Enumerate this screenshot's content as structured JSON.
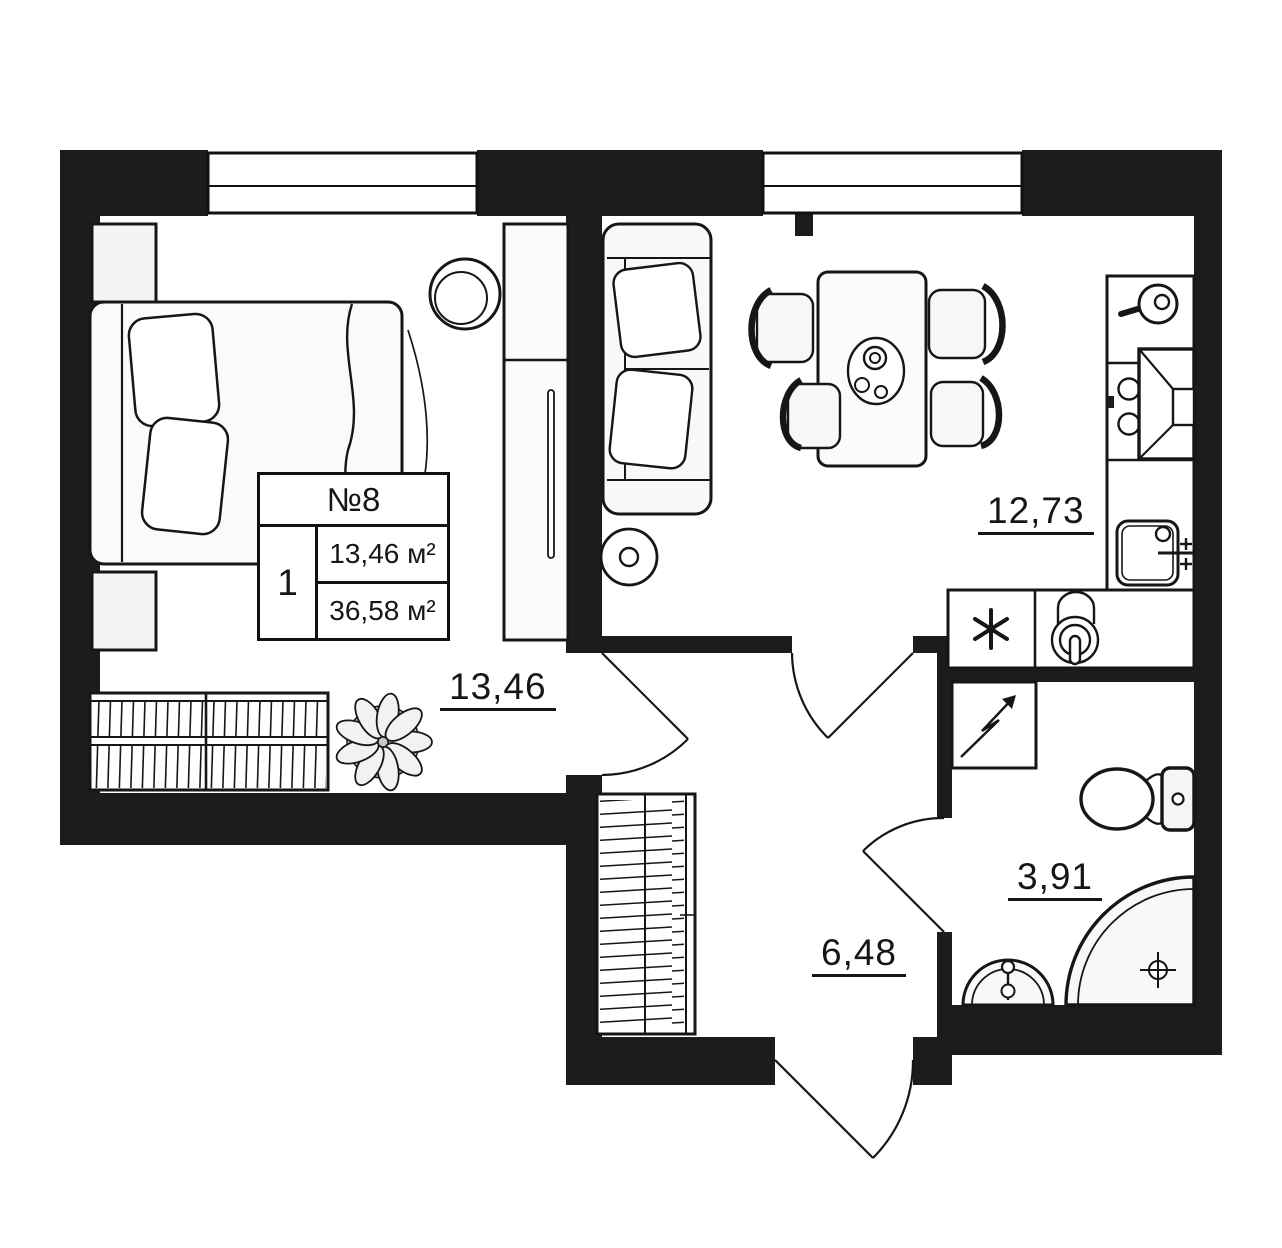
{
  "unit_card": {
    "number": "№8",
    "rooms_count": "1",
    "living_area": "13,46 м²",
    "total_area": "36,58 м²"
  },
  "rooms": [
    {
      "name": "bedroom",
      "area": "13,46"
    },
    {
      "name": "kitchen-living",
      "area": "12,73"
    },
    {
      "name": "hallway",
      "area": "6,48"
    },
    {
      "name": "bathroom",
      "area": "3,91"
    }
  ],
  "icons": {
    "fridge-icon": "✳",
    "water-heater-icon": "↗",
    "window-icon": "▭",
    "door-swing-icon": "◜"
  },
  "colors": {
    "walls": "#1c1c1c",
    "lines": "#161616",
    "furniture_fill": "#f8f8f8",
    "background": "#ffffff"
  }
}
